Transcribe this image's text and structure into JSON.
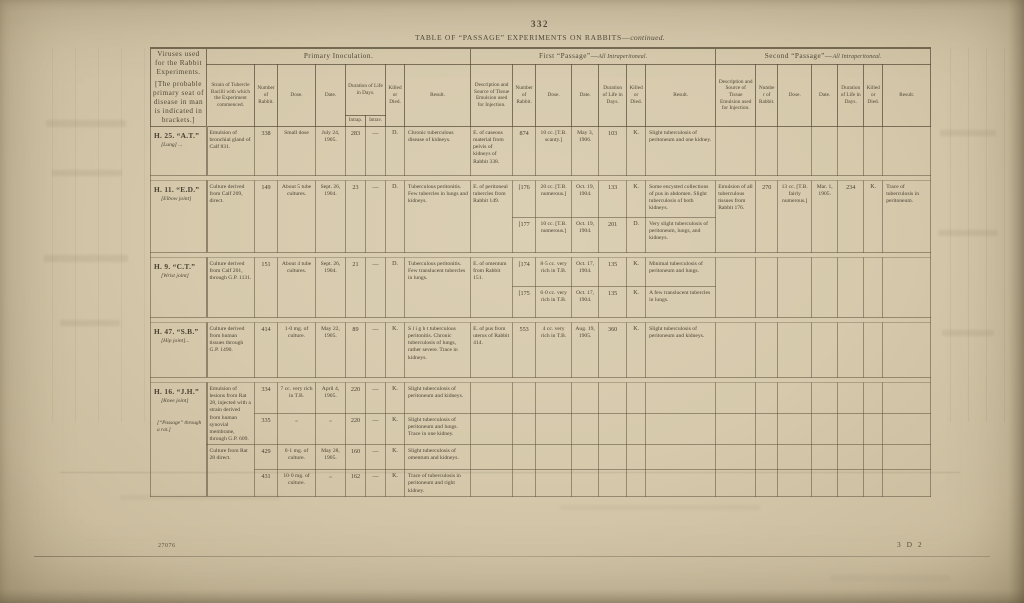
{
  "page": {
    "number": "332",
    "caption_main": "TABLE OF “PASSAGE” EXPERIMENTS ON RABBITS—",
    "caption_note": "continued."
  },
  "footer": {
    "left": "27076",
    "right": "3 D 2"
  },
  "headers": {
    "viruses_title": "Viruses used for the Rabbit Experiments.",
    "viruses_note": "[The probable primary seat of disease in man is indicated in brackets.]",
    "primary_title": "Primary Inoculation.",
    "first_title_main": "First “Passage”—",
    "first_title_note": "All Intraperitoneal.",
    "second_title_main": "Second “Passage”—",
    "second_title_note": "All Intraperitoneal.",
    "strain": "Strain of Tubercle Bacilli with which the Experiment commenced.",
    "number": "Number of Rabbit.",
    "dose": "Dose.",
    "date": "Date.",
    "duration": "Duration of Life in Days.",
    "intrap": "Intrap.",
    "intrav": "Intrav.",
    "killed": "Killed or Died.",
    "result": "Result.",
    "desc": "Description and Source of Tissue Emulsion used for Injection."
  },
  "experiments": [
    {
      "id": "H. 25. “A.T.”",
      "site": "[Lung]  ...",
      "strain": "Emulsion of bronchial gland of Calf 831.",
      "primary": [
        {
          "number": "338",
          "dose": "Small dose",
          "date": "July 24, 1905.",
          "intrap": "283",
          "intrav": "—",
          "killed": "D.",
          "result": "Chronic tuberculous disease of kidneys."
        }
      ],
      "first": {
        "desc": "E. of caseous material from pelvis of kidneys of Rabbit 338.",
        "subs": [
          {
            "number": "874",
            "dose": "10 cc. [T.B. scanty.]",
            "date": "May 3, 1906.",
            "duration": "103",
            "killed": "K.",
            "result": "Slight tuberculosis of peritoneum and one kidney."
          }
        ]
      }
    },
    {
      "id": "H. 11. “E.D.”",
      "site": "[Elbow joint]",
      "strain": "Culture derived from Calf 209, direct.",
      "primary": [
        {
          "number": "149",
          "dose": "About 5 tube cultures.",
          "date": "Sept. 26, 1904.",
          "intrap": "23",
          "intrav": "—",
          "killed": "D.",
          "result": "Tuberculous peritonitis.  Few tubercles in lungs and kidneys."
        }
      ],
      "first": {
        "desc": "E. of peritoneal tubercles from Rabbit 149.",
        "subs": [
          {
            "number": "[176",
            "dose": "20 cc. [T.B. numerous.]",
            "date": "Oct. 19, 1904.",
            "duration": "133",
            "killed": "K.",
            "result": "Some encysted collections of pus in abdomen.  Slight tuberculosis of both kidneys."
          },
          {
            "number": "[177",
            "dose": "10 cc. [T.B. numerous.]",
            "date": "Oct. 19, 1904.",
            "duration": "201",
            "killed": "D.",
            "result": "Very slight tuberculosis of peritoneum, lungs, and kidneys."
          }
        ]
      },
      "second": {
        "desc": "Emulsion of all tuberculous tissues from Rabbit 176.",
        "number": "270",
        "dose": "13 cc. [T.B. fairly numerous.]",
        "date": "Mar. 1, 1905.",
        "duration": "234",
        "killed": "K.",
        "result": "Trace of tuberculosis in peritoneum."
      }
    },
    {
      "id": "H. 9. “C.T.”",
      "site": "[Wrist joint]",
      "strain": "Culture derived from Calf 201, through G.P. 1131.",
      "primary": [
        {
          "number": "151",
          "dose": "About 4 tube cultures.",
          "date": "Sept. 26, 1904.",
          "intrap": "21",
          "intrav": "—",
          "killed": "D.",
          "result": "Tuberculous peritonitis.  Few translucent tubercles in lungs."
        }
      ],
      "first": {
        "desc": "E. of omentum from Rabbit 151.",
        "subs": [
          {
            "number": "[174",
            "dose": "8·5 cc. very rich in T.B.",
            "date": "Oct. 17, 1904.",
            "duration": "135",
            "killed": "K.",
            "result": "Minimal tuberculosis of peritoneum and lungs."
          },
          {
            "number": "[175",
            "dose": "6·0 cc. very rich in T.B.",
            "date": "Oct. 17, 1904.",
            "duration": "135",
            "killed": "K.",
            "result": "A few translucent tubercles in lungs."
          }
        ]
      }
    },
    {
      "id": "H. 47. “S.B.”",
      "site": "[Hip joint]...",
      "strain": "Culture derived from human tissues through G.P. 1490.",
      "primary": [
        {
          "number": "414",
          "dose": "1·0 mg. of culture.",
          "date": "May 22, 1905.",
          "intrap": "89",
          "intrav": "—",
          "killed": "K.",
          "result": "S l i g h t  tuberculous peritonitis.  Chronic tuberculosis of lungs, rather severe.  Trace in kidneys."
        }
      ],
      "first": {
        "desc": "E. of pus from uterus of Rabbit 414.",
        "subs": [
          {
            "number": "553",
            "dose": "4 cc. very rich in T.B.",
            "date": "Aug. 19, 1905.",
            "duration": "360",
            "killed": "K.",
            "result": "Slight tuberculosis of peritoneum and kidneys."
          }
        ]
      }
    },
    {
      "id": "H. 16. “J.H.”",
      "site": "[Knee joint]",
      "site_note": "[“Passage” through a rat.]",
      "strain_a": "Emulsion of lesions from Rat 28, injected with a strain derived from human synovial membrane, through G.P. 609.",
      "strain_b": "Culture from Rat 28 direct.",
      "primary": [
        {
          "number": "334",
          "dose": "7 cc. very rich in T.B.",
          "date": "April 4, 1905.",
          "intrap": "220",
          "intrav": "—",
          "killed": "K.",
          "result": "Slight tuberculosis of peritoneum and kidneys."
        },
        {
          "number": "335",
          "dose": "„",
          "date": "„",
          "intrap": "220",
          "intrav": "—",
          "killed": "K.",
          "result": "Slight tuberculosis of peritoneum and lungs.  Trace in one kidney."
        },
        {
          "number": "429",
          "dose": "0·1 mg. of culture.",
          "date": "May 28, 1905.",
          "intrap": "160",
          "intrav": "—",
          "killed": "K.",
          "result": "Slight tuberculosis of omentum and kidneys."
        },
        {
          "number": "431",
          "dose": "10·0 mg. of culture.",
          "date": "„",
          "intrap": "162",
          "intrav": "—",
          "killed": "K.",
          "result": "Trace of tuberculosis in peritoneum and right kidney."
        }
      ]
    }
  ]
}
